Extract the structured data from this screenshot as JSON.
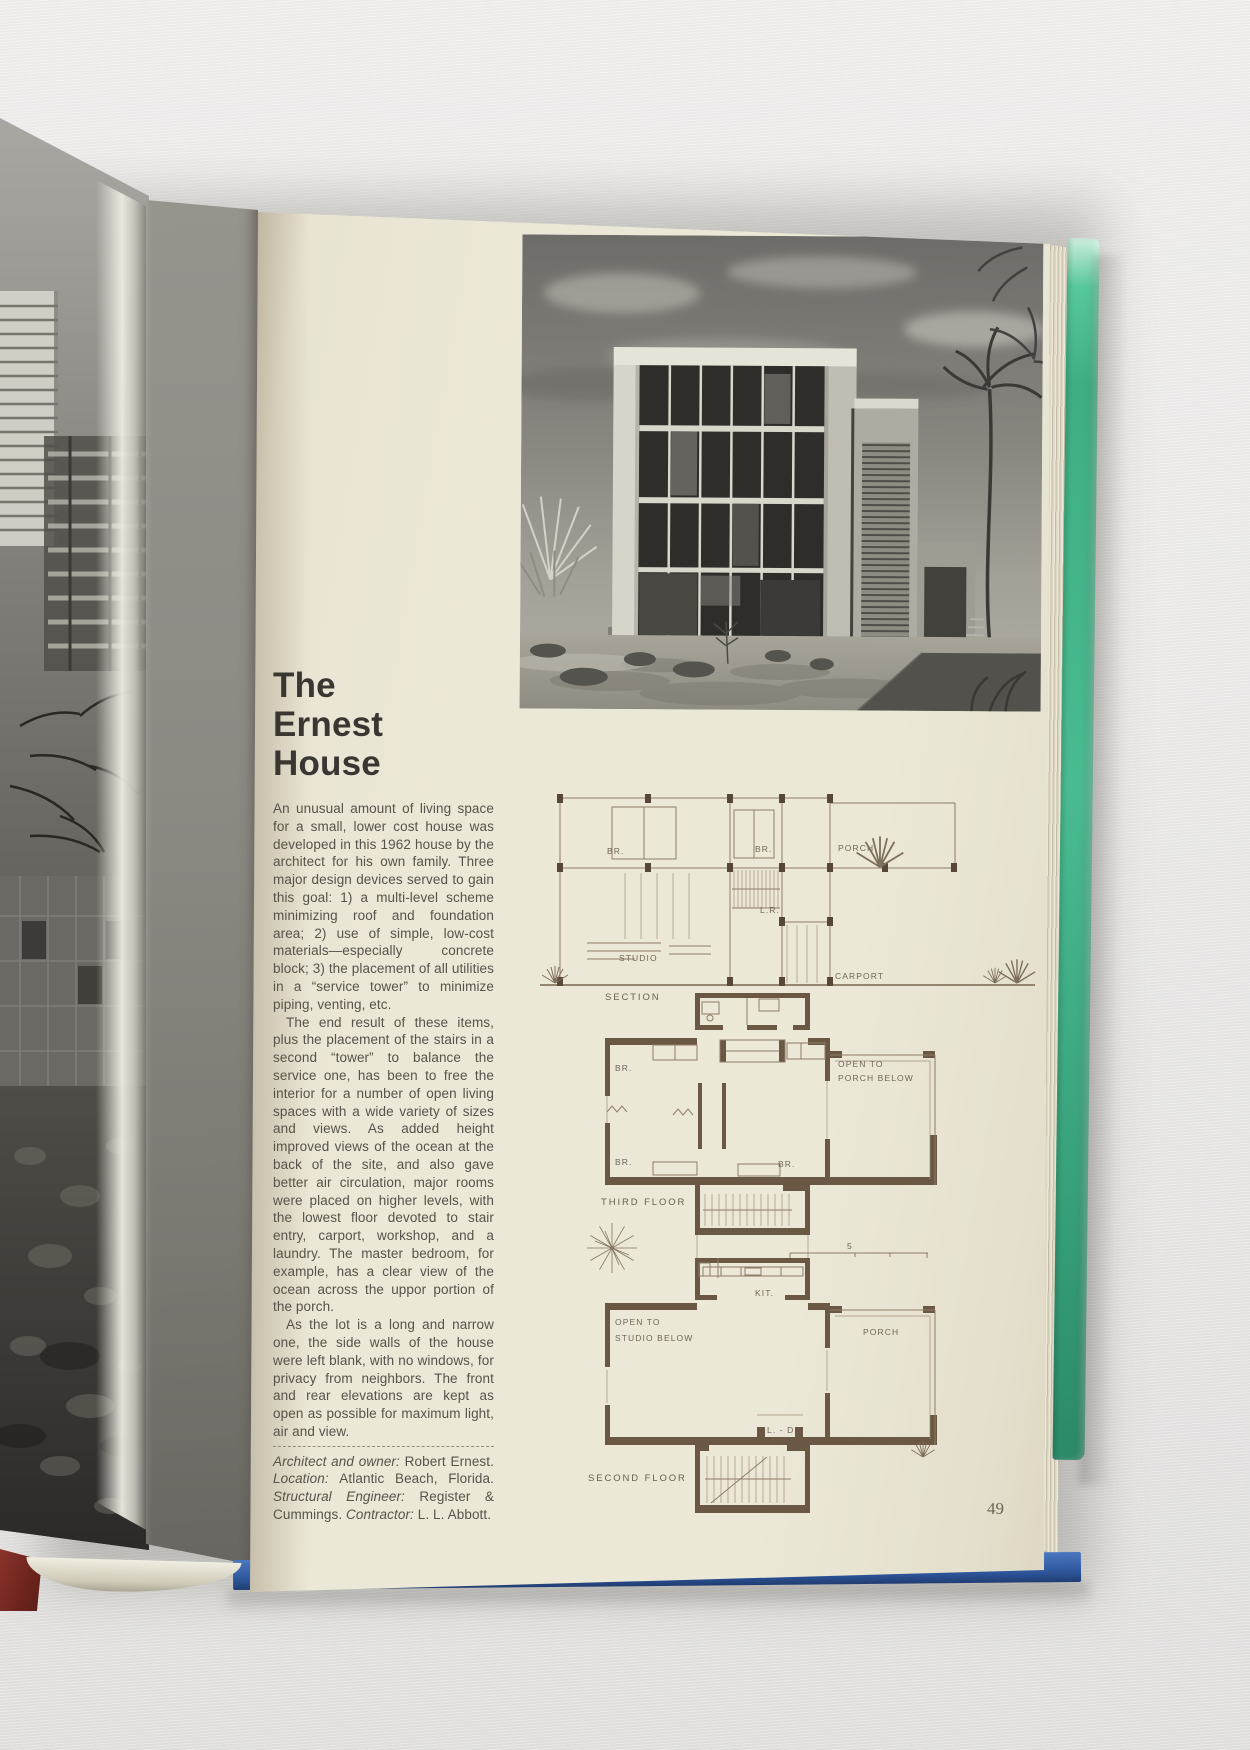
{
  "book": {
    "title_lines": [
      "The",
      "Ernest",
      "House"
    ],
    "paragraphs": [
      "An unusual amount of living space for a small, lower cost house was developed in this 1962 house by the architect for his own family. Three major design devices served to gain this goal: 1) a multi-level scheme minimizing roof and foundation area; 2) use of simple, low-cost materials—especially concrete block; 3) the placement of all utilities in a “service tower” to minimize piping, venting, etc.",
      "The end result of these items, plus the placement of the stairs in a second “tower” to balance the service one, has been to free the interior for a number of open living spaces with a wide variety of sizes and views. As added height improved views of the ocean at the back of the site, and also gave better air circulation, major rooms were placed on higher levels, with the lowest floor devoted to stair entry, carport, workshop, and a laundry. The master bedroom, for example, has a clear view of the ocean across the uppor portion of the porch.",
      "As the lot is a long and narrow one, the side walls of the house were left blank, with no windows, for privacy from neighbors. The front and rear elevations are kept as open as possible for maximum light, air and view."
    ],
    "credits": [
      {
        "label": "Architect and owner: ",
        "value": "Robert Ernest. "
      },
      {
        "label": "Location: ",
        "value": "Atlantic Beach, Florida. "
      },
      {
        "label": "Structural Engineer: ",
        "value": "Register & Cummings. "
      },
      {
        "label": "Contractor: ",
        "value": "L. L. Abbott."
      }
    ],
    "page_number": "49",
    "plans": {
      "section": {
        "caption": "SECTION",
        "br_left": "BR.",
        "br_mid": "BR.",
        "porch": "PORCH",
        "lr": "L.R.",
        "studio": "STUDIO",
        "carport": "CARPORT"
      },
      "third_floor": {
        "caption": "THIRD FLOOR",
        "br_top": "BR.",
        "open_line1": "OPEN TO",
        "open_line2": "PORCH BELOW",
        "br_bottom_left": "BR.",
        "br_bottom_mid": "BR."
      },
      "second_floor": {
        "caption": "SECOND FLOOR",
        "kit": "KIT.",
        "open_line1": "OPEN TO",
        "open_line2": "STUDIO BELOW",
        "porch": "PORCH",
        "ld": "L. - D."
      },
      "scale_number": "5"
    }
  },
  "colors": {
    "page_cream": "#ece8d8",
    "cover_green": "#44b58a",
    "cover_blue": "#2e58a0",
    "plan_ink": "#6a5845",
    "text_ink": "#57524a"
  }
}
